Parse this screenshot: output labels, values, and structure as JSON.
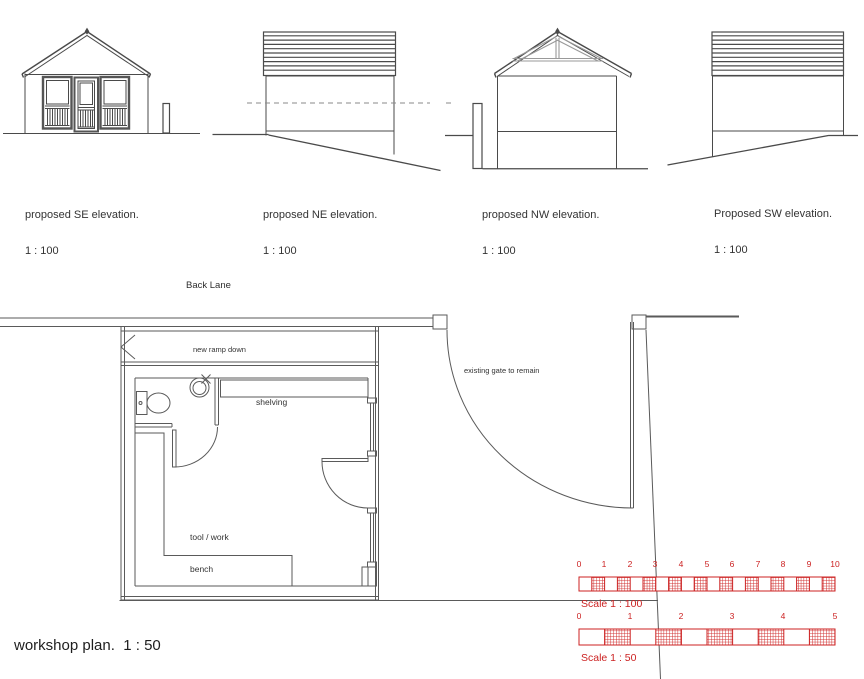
{
  "drawing": {
    "elevations": [
      {
        "label": "proposed SE elevation.",
        "scale": "1 : 100"
      },
      {
        "label": "proposed NE elevation.",
        "scale": "1 : 100"
      },
      {
        "label": "proposed NW elevation.",
        "scale": "1 : 100"
      },
      {
        "label": "Proposed SW elevation.",
        "scale": "1 : 100"
      }
    ],
    "plan": {
      "title": "workshop plan.  1 : 50",
      "street_label": "Back Lane",
      "annotations": {
        "ramp": "new ramp down",
        "gate": "existing gate to remain",
        "shelving": "shelving",
        "bench_line1": "tool / work",
        "bench_line2": "bench"
      }
    },
    "scale_bars": [
      {
        "label": "Scale 1 : 100",
        "ticks": [
          "0",
          "1",
          "2",
          "3",
          "4",
          "5",
          "6",
          "7",
          "8",
          "9",
          "10"
        ]
      },
      {
        "label": "Scale 1 : 50",
        "ticks": [
          "0",
          "1",
          "2",
          "3",
          "4",
          "5"
        ]
      }
    ],
    "colors": {
      "accent_red": "#cc2222",
      "line": "#4a4a4a"
    }
  }
}
